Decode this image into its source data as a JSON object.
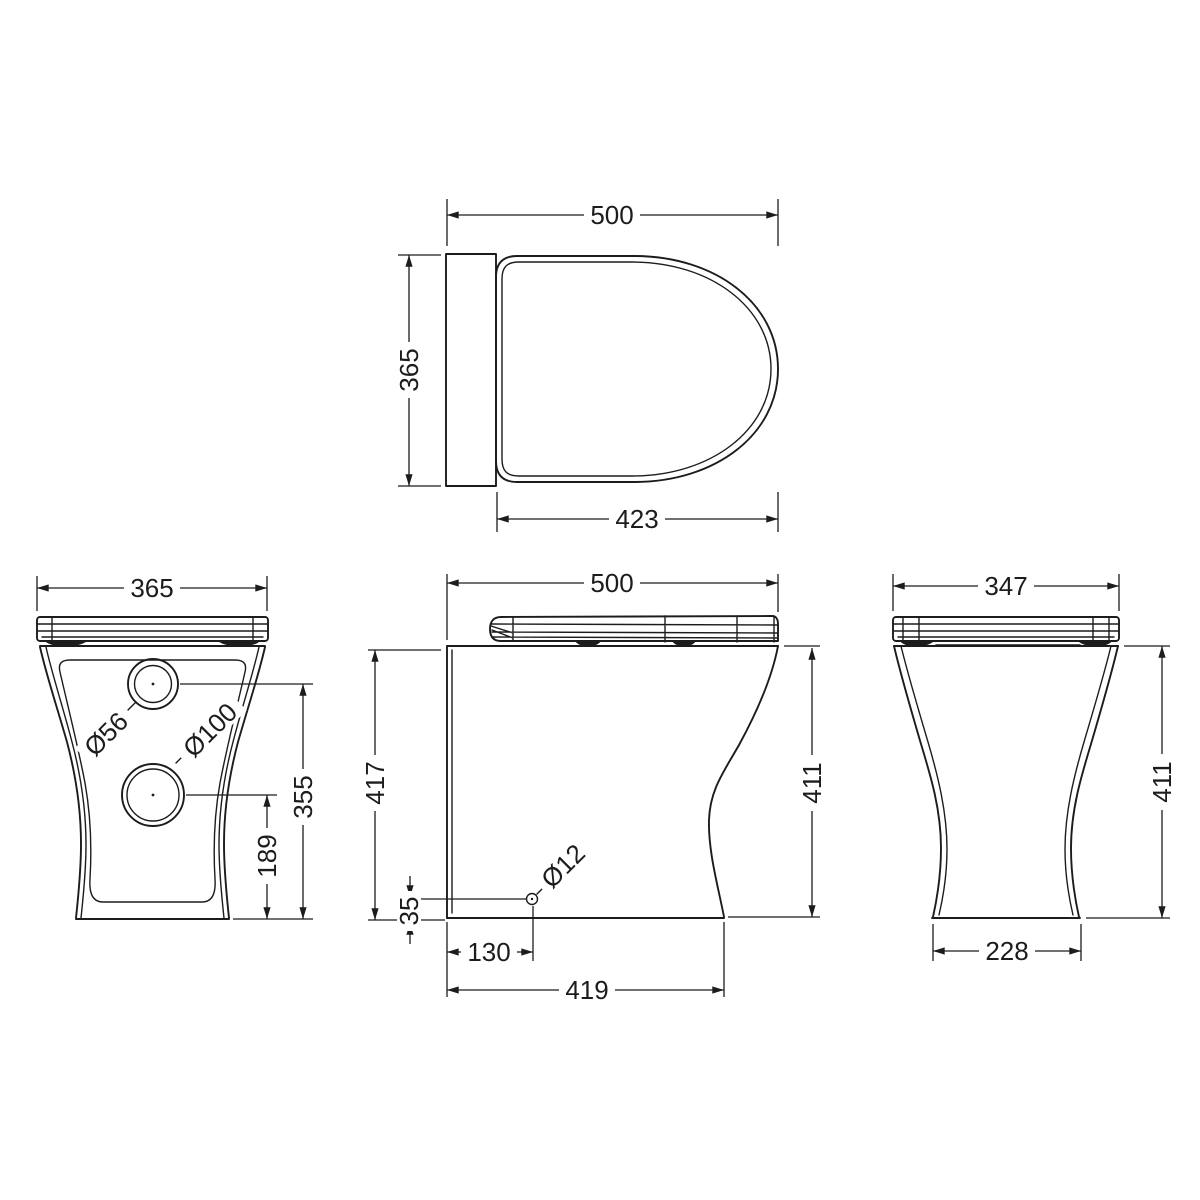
{
  "colors": {
    "background": "#ffffff",
    "line": "#1c1c1c"
  },
  "views": {
    "plan": {
      "width": "500",
      "depth": "365",
      "seat_length": "423"
    },
    "back": {
      "width": "365",
      "inlet_height": "355",
      "outlet_height": "189",
      "inlet_dia": "Ø56",
      "outlet_dia": "Ø100"
    },
    "side": {
      "depth": "500",
      "overall_height": "417",
      "height": "411",
      "fixing_height": "35",
      "fixing_inset": "130",
      "base_depth": "419",
      "fixing_dia": "Ø12"
    },
    "front": {
      "width": "347",
      "height": "411",
      "base_width": "228"
    }
  }
}
